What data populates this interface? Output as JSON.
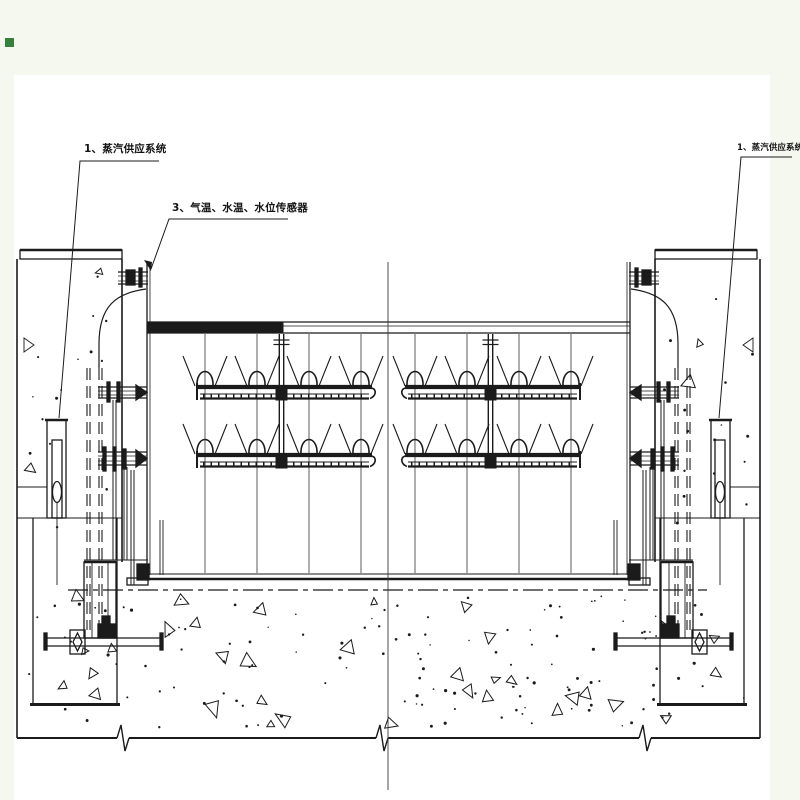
{
  "colors": {
    "margin": "#f5f8ee",
    "paper": "#ffffff",
    "ink": "#1b1b1b",
    "centerline": "#3a3a3a",
    "accent_square": "#35803a"
  },
  "labels": {
    "steam_supply_left": "1、蒸汽供应系统",
    "steam_supply_right": "1、蒸汽供应系统",
    "sensors": "3、气温、水温、水位传感器"
  },
  "drawing": {
    "type": "technical-section",
    "rows_y": [
      387,
      455
    ],
    "halves": [
      {
        "bar_x": [
          197,
          372
        ],
        "hook": "right",
        "nozzle_x": [
          205,
          257,
          309,
          361
        ],
        "supply_x": 281.5
      },
      {
        "bar_x": [
          405,
          580
        ],
        "hook": "left",
        "nozzle_x": [
          415,
          467,
          519,
          571
        ],
        "supply_x": 490.5
      }
    ],
    "column_top": 334,
    "column_bottom": 573,
    "tank": {
      "left": 147,
      "right": 630,
      "top": 322,
      "bottom": 579
    },
    "foundation_y": 738,
    "phantom_y": 590,
    "center_x": 388,
    "breaks_x": [
      123,
      382,
      645
    ]
  }
}
